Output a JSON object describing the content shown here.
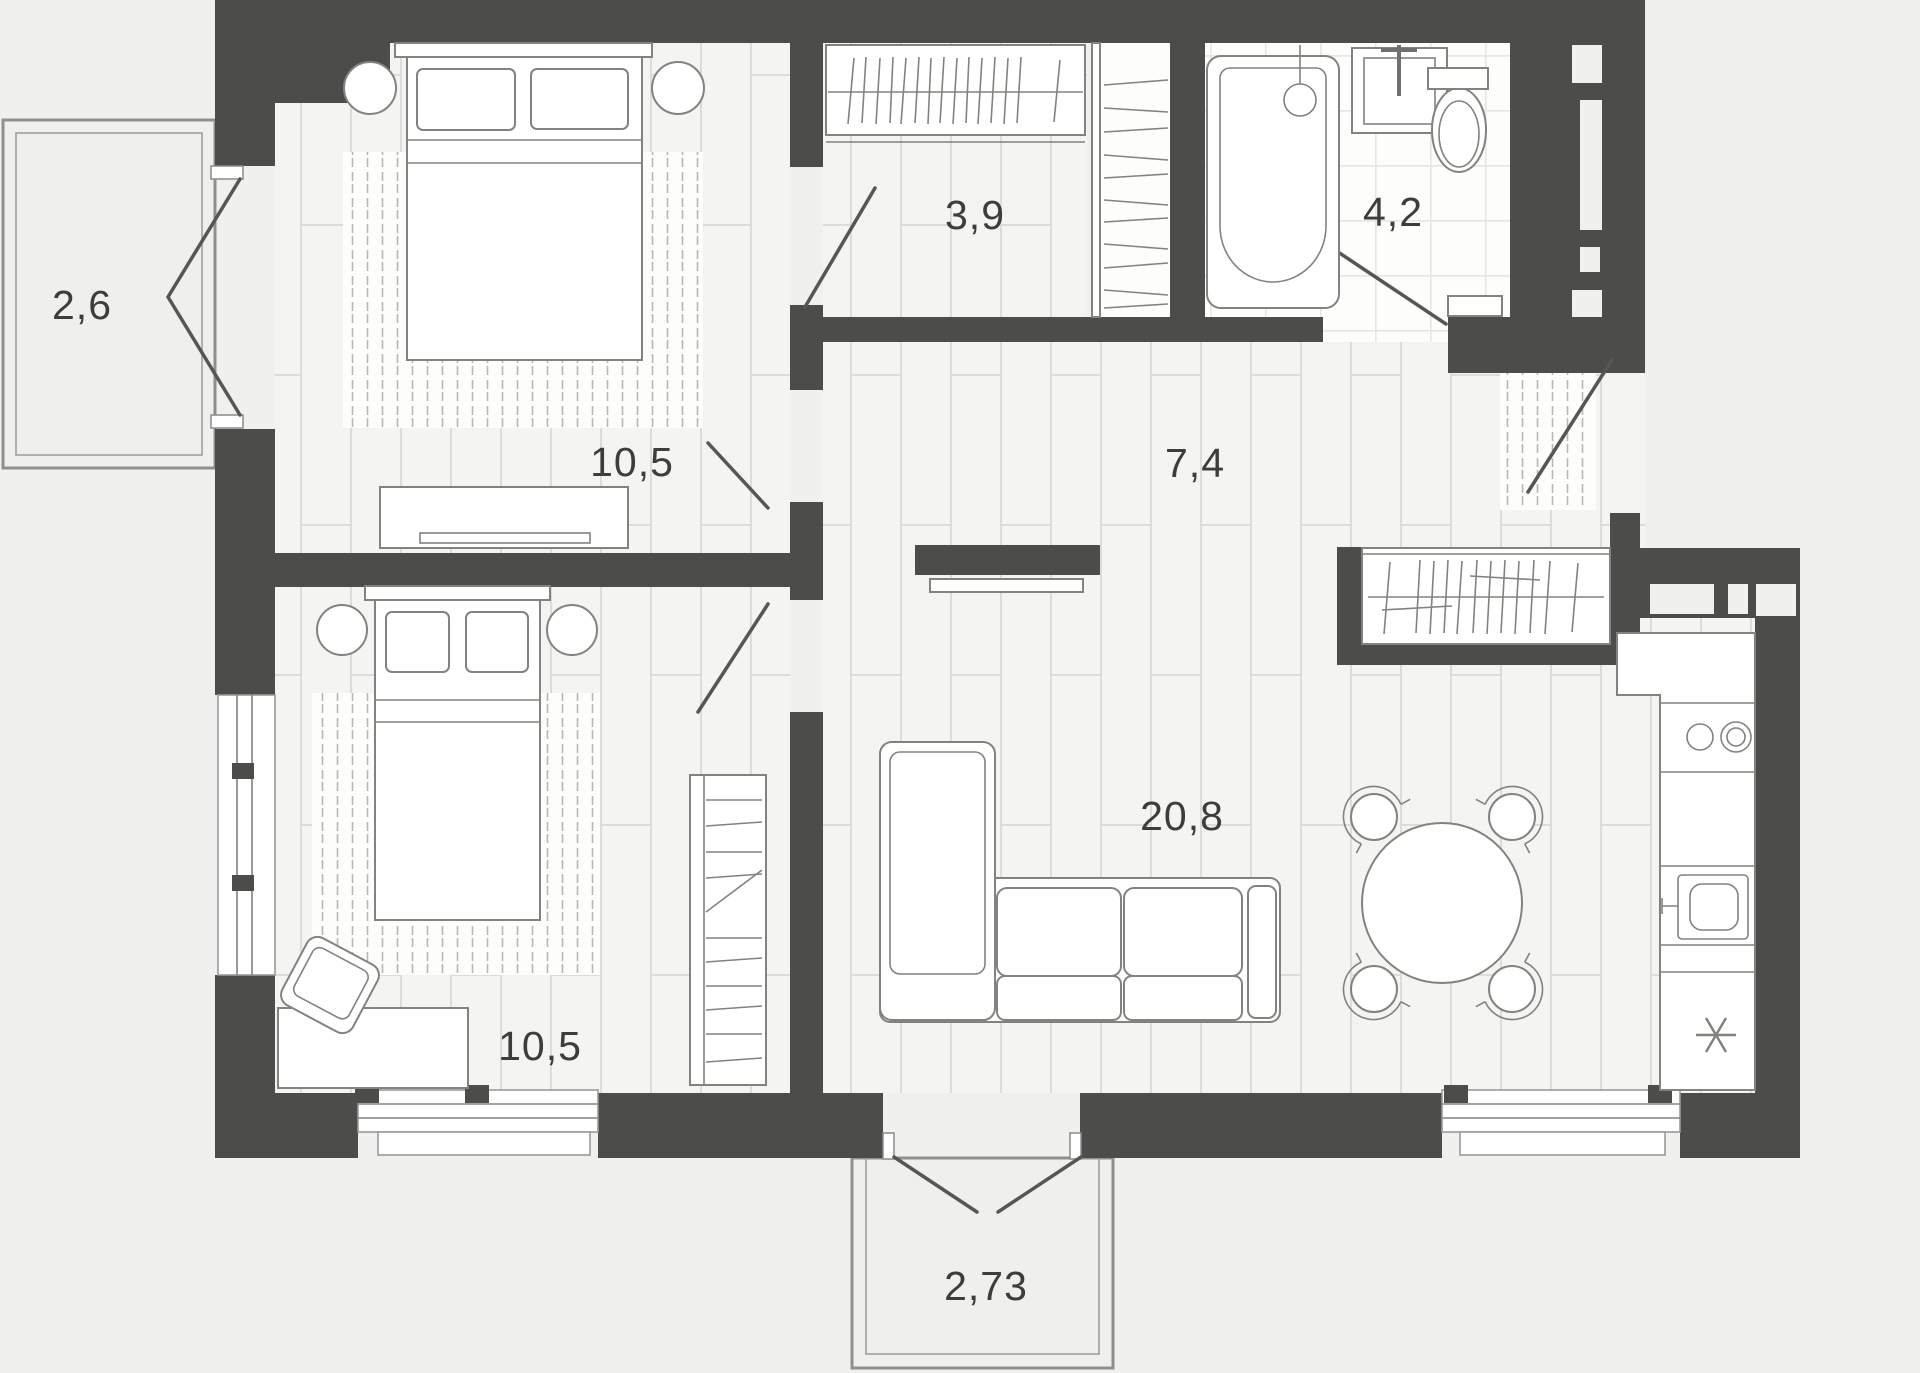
{
  "plan": {
    "type": "apartment-floor-plan",
    "units": "m2",
    "rooms": [
      {
        "id": "bedroom-1",
        "area_label": "10,5"
      },
      {
        "id": "wardrobe",
        "area_label": "3,9"
      },
      {
        "id": "bathroom",
        "area_label": "4,2"
      },
      {
        "id": "hallway",
        "area_label": "7,4"
      },
      {
        "id": "bedroom-2",
        "area_label": "10,5"
      },
      {
        "id": "living-kitchen",
        "area_label": "20,8"
      },
      {
        "id": "balcony-left",
        "area_label": "2,6"
      },
      {
        "id": "balcony-bottom",
        "area_label": "2,73"
      }
    ],
    "fixtures": {
      "bedroom-1": [
        "double-bed",
        "pillows",
        "nightstand",
        "nightstand",
        "rug",
        "dresser",
        "door"
      ],
      "wardrobe": [
        "hanging-rail",
        "hangers",
        "shelf-column",
        "door"
      ],
      "bathroom": [
        "bathtub",
        "faucet",
        "sink",
        "toilet",
        "shelf",
        "door"
      ],
      "hallway": [
        "entry-door",
        "doormat",
        "closet-with-hangers",
        "tv-panel",
        "tv-console"
      ],
      "bedroom-2": [
        "double-bed",
        "pillows",
        "nightstand",
        "nightstand",
        "rug",
        "desk",
        "desk-chair",
        "shelving-unit",
        "window",
        "door"
      ],
      "living-kitchen": [
        "corner-sofa",
        "dining-table",
        "chair",
        "chair",
        "chair",
        "chair",
        "kitchen-counter",
        "hob",
        "kitchen-sink",
        "refrigerator",
        "window"
      ],
      "balcony-left": [
        "french-doors"
      ],
      "balcony-bottom": [
        "french-doors"
      ]
    },
    "colors": {
      "wall": "#4c4c4a",
      "background": "#f0f0ee",
      "wood_floor": "#f4f4f2",
      "tile_floor": "#fdfdfc",
      "floor_line": "#dcdcda",
      "furniture_line": "#82827f",
      "label_text": "#3d3d3b"
    }
  }
}
